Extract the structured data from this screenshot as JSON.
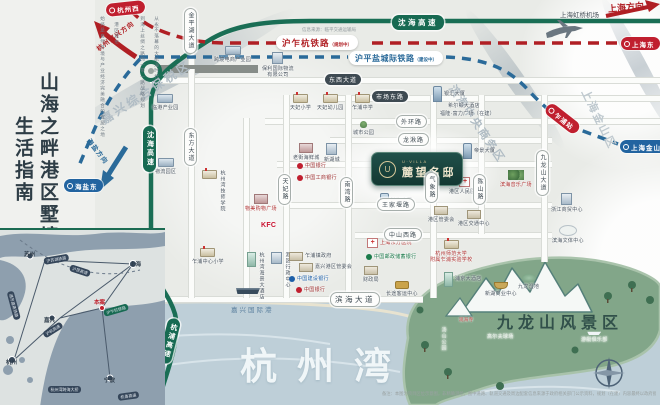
{
  "palette": {
    "bg": "#e9ebe7",
    "green": "#176a52",
    "red": "#b01f24",
    "blue": "#2a6a99",
    "ink": "#2e3d46"
  },
  "left_panel": {
    "title_col_1": "山海之畔港区墅境",
    "title_col_2": "生活指南",
    "intro_col_1": "从永不落幕的大航海时代",
    "intro_col_2": "到海上丝绸之路的一带一路战略规划",
    "intro_col_3": "港区城市",
    "intro_col_4": "始终是自然环境与产业经济完美融合的宜居之地"
  },
  "header": {
    "info_source": "信息来源：临平交通运输局",
    "airport": "上海虹桥机场",
    "dir_shanghai": "上海方向",
    "dir_hangjia": "杭州嘉兴方向",
    "dir_haiyan": "海盐方向"
  },
  "railways": [
    {
      "name": "沪乍杭铁路",
      "status": "（规划中）"
    },
    {
      "name": "沪平盐城际铁路",
      "status": "（建设中）"
    }
  ],
  "project": {
    "brand": "U·VILLA",
    "name": "麓望名邸",
    "logo": "U"
  },
  "labels": {
    "bay": "杭州湾",
    "scenic": "九龙山风景区",
    "port": "嘉兴国际港",
    "disclaimer": "备注：本图为项目区位示意图，非精确测绘；图中道路、轨道交通及周边配套信息来源于政府相关部门公示资料，规划（在建）内容最终以政府批复文件及实际建成情况为准；本图仅供参考，不构成要约或承诺。"
  },
  "map": {
    "road_lines": [
      {
        "o": "h",
        "x": 150,
        "y": 77,
        "l": 510
      },
      {
        "o": "h",
        "x": 330,
        "y": 95,
        "l": 330
      },
      {
        "o": "h",
        "x": 265,
        "y": 118,
        "l": 395
      },
      {
        "o": "h",
        "x": 330,
        "y": 137,
        "l": 222
      },
      {
        "o": "h",
        "x": 277,
        "y": 161,
        "l": 275
      },
      {
        "o": "h",
        "x": 287,
        "y": 202,
        "l": 265
      },
      {
        "o": "h",
        "x": 355,
        "y": 232,
        "l": 197
      },
      {
        "o": "h",
        "x": 95,
        "y": 296,
        "l": 328
      },
      {
        "o": "g",
        "x": 158,
        "y": 67,
        "l": 100
      },
      {
        "o": "v",
        "x": 188,
        "y": 18,
        "l": 280
      },
      {
        "o": "v",
        "x": 283,
        "y": 95,
        "l": 203
      },
      {
        "o": "v",
        "x": 345,
        "y": 95,
        "l": 203
      },
      {
        "o": "v",
        "x": 430,
        "y": 95,
        "l": 203
      },
      {
        "o": "v",
        "x": 478,
        "y": 95,
        "l": 139
      },
      {
        "o": "v",
        "x": 541,
        "y": 95,
        "l": 167
      },
      {
        "o": "v",
        "x": 243,
        "y": 118,
        "l": 180
      }
    ],
    "road_labels": [
      {
        "t": "东西大道",
        "x": 325,
        "y": 74,
        "v": "dark"
      },
      {
        "t": "市场东路",
        "x": 372,
        "y": 91,
        "v": "dark"
      },
      {
        "t": "外环路",
        "x": 396,
        "y": 115,
        "v": "light"
      },
      {
        "t": "龙湫路",
        "x": 398,
        "y": 133,
        "v": "light"
      },
      {
        "t": "王家堰路",
        "x": 377,
        "y": 198,
        "v": "light"
      },
      {
        "t": "中山西路",
        "x": 384,
        "y": 228,
        "v": "light"
      },
      {
        "t": "滨海大道",
        "x": 330,
        "y": 292,
        "v": "light big"
      },
      {
        "t": "金平湖大道",
        "x": 184,
        "y": 8,
        "v": "vert"
      },
      {
        "t": "东方大道",
        "x": 184,
        "y": 128,
        "v": "vert"
      },
      {
        "t": "天妃路",
        "x": 278,
        "y": 174,
        "v": "vert"
      },
      {
        "t": "南湾路",
        "x": 340,
        "y": 177,
        "v": "vert"
      },
      {
        "t": "气象路",
        "x": 425,
        "y": 172,
        "v": "vert"
      },
      {
        "t": "陈山路",
        "x": 473,
        "y": 174,
        "v": "vert"
      },
      {
        "t": "九龙山大道",
        "x": 536,
        "y": 150,
        "v": "vert"
      },
      {
        "t": "沈海高速",
        "x": 392,
        "y": 15,
        "v": "green"
      },
      {
        "t": "沈海高速",
        "x": 143,
        "y": 126,
        "v": "greenv"
      },
      {
        "t": "杭浦高速",
        "x": 163,
        "y": 318,
        "v": "greenv",
        "rot": 14
      }
    ],
    "stations": [
      {
        "t": "杭州西",
        "x": 106,
        "y": 2,
        "c": "red",
        "rot": -6
      },
      {
        "t": "上海东",
        "x": 621,
        "y": 37,
        "c": "red"
      },
      {
        "t": "海盐东",
        "x": 64,
        "y": 179,
        "c": "blue"
      },
      {
        "t": "上海金山",
        "x": 620,
        "y": 140,
        "c": "blue"
      },
      {
        "t": "乍浦站",
        "x": 543,
        "y": 112,
        "c": "red",
        "rot": 38
      }
    ],
    "area_labels": [
      {
        "t": "嘉兴综合保税区",
        "x": 102,
        "y": 112,
        "rot": -33,
        "s": 12,
        "c": "#b0bcc4",
        "sp": 3
      },
      {
        "t": "滨海中央商务区",
        "x": 452,
        "y": 78,
        "rot": 56,
        "s": 11,
        "c": "#b0bcc4",
        "sp": 2
      },
      {
        "t": "上海金山区",
        "x": 585,
        "y": 82,
        "rot": 64,
        "s": 11,
        "c": "#bfc9cf",
        "sp": 2
      }
    ],
    "pois": [
      {
        "x": 152,
        "y": 94,
        "icon": "factory",
        "t": "临港产业园"
      },
      {
        "x": 155,
        "y": 158,
        "icon": "factory",
        "t": "物流园区"
      },
      {
        "x": 214,
        "y": 46,
        "icon": "factory",
        "t": "跨境电商产业园"
      },
      {
        "x": 262,
        "y": 52,
        "icon": "office",
        "t": "保利国际物流\n有限公司"
      },
      {
        "x": 290,
        "y": 94,
        "icon": "school",
        "t": "天妃小学"
      },
      {
        "x": 317,
        "y": 94,
        "icon": "school",
        "t": "天妃幼儿园"
      },
      {
        "x": 352,
        "y": 94,
        "icon": "school",
        "t": "乍浦中学"
      },
      {
        "x": 353,
        "y": 121,
        "icon": "tree",
        "t": "城市公园"
      },
      {
        "x": 293,
        "y": 143,
        "icon": "mall",
        "t": "老街海鲜城"
      },
      {
        "x": 324,
        "y": 143,
        "icon": "building",
        "t": "新湖城"
      },
      {
        "x": 297,
        "y": 163,
        "icon": "bank",
        "bc": "#c01f2f",
        "t": "中国银行",
        "lc": "#9c2b2b",
        "row": true
      },
      {
        "x": 297,
        "y": 175,
        "icon": "bank",
        "bc": "#c01f2f",
        "t": "中国工商银行",
        "lc": "#9c2b2b",
        "row": true
      },
      {
        "x": 245,
        "y": 194,
        "icon": "mall",
        "t": "物美购物广场",
        "lc": "#b03030"
      },
      {
        "x": 261,
        "y": 221,
        "icon": "none",
        "t": "KFC",
        "lc": "#c8102e",
        "s": 7,
        "bold": true
      },
      {
        "x": 202,
        "y": 170,
        "icon": "school",
        "t": "杭州湾技师学院",
        "vert": true
      },
      {
        "x": 433,
        "y": 86,
        "icon": "tower",
        "t": "银汇大厦",
        "row": true
      },
      {
        "x": 448,
        "y": 103,
        "icon": "none",
        "t": "希尔顿大酒店"
      },
      {
        "x": 440,
        "y": 111,
        "icon": "none",
        "t": "福隆·富力广场（在建）"
      },
      {
        "x": 437,
        "y": 153,
        "icon": "park",
        "t": "滨海公园"
      },
      {
        "x": 463,
        "y": 143,
        "icon": "tower",
        "t": "帝景大厦",
        "row": true
      },
      {
        "x": 449,
        "y": 177,
        "icon": "hospital",
        "t": "港区人民医院"
      },
      {
        "x": 500,
        "y": 170,
        "icon": "trees",
        "t": "滨海音乐广场",
        "lc": "#b03030"
      },
      {
        "x": 551,
        "y": 193,
        "icon": "building",
        "t": "浙江商贸中心"
      },
      {
        "x": 552,
        "y": 225,
        "icon": "stadium",
        "t": "滨海文体中心"
      },
      {
        "x": 367,
        "y": 238,
        "icon": "hospital",
        "t": "上海东方医院",
        "lc": "#b03030",
        "row": true
      },
      {
        "x": 366,
        "y": 254,
        "icon": "bank",
        "bc": "#1a7a4a",
        "t": "中国邮政储蓄银行",
        "lc": "#1a7a4a",
        "row": true
      },
      {
        "x": 430,
        "y": 240,
        "icon": "school",
        "t": "杭州师范大学\n附属乍浦实验学校",
        "lc": "#b03030"
      },
      {
        "x": 428,
        "y": 206,
        "icon": "gov",
        "t": "港区管委会"
      },
      {
        "x": 458,
        "y": 210,
        "icon": "gov",
        "t": "港区交通中心"
      },
      {
        "x": 363,
        "y": 266,
        "icon": "gov",
        "t": "财政局"
      },
      {
        "x": 386,
        "y": 281,
        "icon": "bus",
        "t": "长途客运中心"
      },
      {
        "x": 444,
        "y": 272,
        "icon": "hotel",
        "t": "浦京大酒店",
        "row": true
      },
      {
        "x": 485,
        "y": 282,
        "icon": "boat",
        "t": "新湖商业中心"
      },
      {
        "x": 518,
        "y": 274,
        "icon": "wetland",
        "t": "九龙湿地"
      },
      {
        "x": 192,
        "y": 248,
        "icon": "school",
        "t": "乍浦中心小学"
      },
      {
        "x": 247,
        "y": 252,
        "icon": "hotel",
        "t": "杭州湾海景大酒店",
        "vert": true
      },
      {
        "x": 271,
        "y": 252,
        "icon": "building",
        "t": "港区行政中心",
        "vert": true
      },
      {
        "x": 289,
        "y": 252,
        "icon": "gov",
        "t": "乍浦镇政府",
        "row": true
      },
      {
        "x": 299,
        "y": 263,
        "icon": "gov",
        "t": "嘉兴港区管委会",
        "row": true
      },
      {
        "x": 289,
        "y": 276,
        "icon": "bank",
        "bc": "#1c5fa8",
        "t": "中国建设银行",
        "lc": "#1c5fa8",
        "row": true
      },
      {
        "x": 296,
        "y": 287,
        "icon": "bank",
        "bc": "#c01f2f",
        "t": "中国银行",
        "lc": "#9c2b2b",
        "row": true
      },
      {
        "x": 236,
        "y": 285,
        "icon": "ship",
        "t": ""
      },
      {
        "x": 380,
        "y": 193,
        "icon": "tower",
        "t": "滨海大厦",
        "row": true
      },
      {
        "x": 459,
        "y": 317,
        "icon": "none",
        "t": "观海寺",
        "lc": "#c04848",
        "s": 4.5
      },
      {
        "x": 487,
        "y": 334,
        "icon": "none",
        "t": "高尔夫球场",
        "lc": "#e9f1e9",
        "s": 5
      },
      {
        "x": 581,
        "y": 329,
        "icon": "yacht",
        "t": "游艇俱乐部",
        "lc": "#e9f1e9",
        "s": 5
      },
      {
        "x": 440,
        "y": 327,
        "icon": "none",
        "t": "汤山公园",
        "lc": "#dfe9df",
        "vert": true,
        "s": 5
      }
    ]
  },
  "inset": {
    "cities": [
      {
        "t": "上海",
        "x": 130,
        "y": 30
      },
      {
        "t": "苏州",
        "x": 24,
        "y": 20
      },
      {
        "t": "嘉兴",
        "x": 44,
        "y": 86
      },
      {
        "t": "杭州",
        "x": 6,
        "y": 128
      },
      {
        "t": "宁波",
        "x": 104,
        "y": 146
      }
    ],
    "routes": [
      {
        "t": "沪苏湖铁路",
        "x": 44,
        "y": 28,
        "rot": -10
      },
      {
        "t": "通苏嘉甬铁路",
        "x": 10,
        "y": 58,
        "rot": 75
      },
      {
        "t": "沪昆高速",
        "x": 70,
        "y": 34,
        "rot": 18
      },
      {
        "t": "沪乍杭铁路",
        "x": 104,
        "y": 80,
        "rot": -16,
        "hl": true
      },
      {
        "t": "沪杭高速",
        "x": 44,
        "y": 102,
        "rot": -32
      },
      {
        "t": "杭州湾跨海大桥",
        "x": 48,
        "y": 156,
        "rot": 0
      },
      {
        "t": "杭甬高速",
        "x": 118,
        "y": 164,
        "rot": -8
      }
    ],
    "marker": "本案"
  }
}
